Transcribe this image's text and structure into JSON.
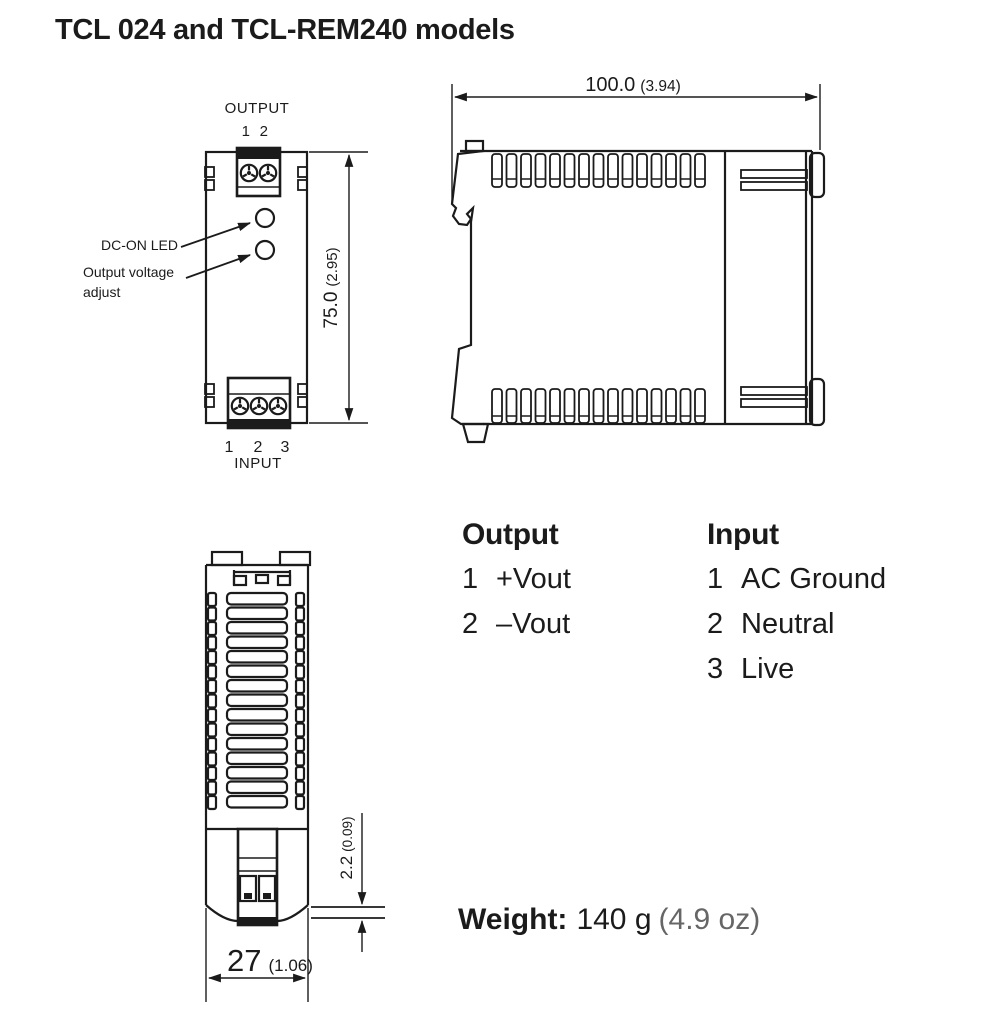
{
  "title": "TCL 024 and TCL-REM240 models",
  "front_view": {
    "output_label": "OUTPUT",
    "output_pin_1": "1",
    "output_pin_2": "2",
    "dc_on_led_label": "DC-ON LED",
    "adjust_label_line1": "Output voltage",
    "adjust_label_line2": "adjust",
    "height_mm": "75.0",
    "height_in": "(2.95)",
    "input_pin_1": "1",
    "input_pin_2": "2",
    "input_pin_3": "3",
    "input_label": "INPUT"
  },
  "side_view": {
    "width_mm": "100.0",
    "width_in": "(3.94)"
  },
  "top_view": {
    "depth_mm": "27",
    "depth_in": "(1.06)",
    "protrusion_mm": "2.2",
    "protrusion_in": "(0.09)"
  },
  "legend": {
    "output_heading": "Output",
    "output_items": [
      {
        "num": "1",
        "label": "+Vout"
      },
      {
        "num": "2",
        "label": "–Vout"
      }
    ],
    "input_heading": "Input",
    "input_items": [
      {
        "num": "1",
        "label": "AC Ground"
      },
      {
        "num": "2",
        "label": "Neutral"
      },
      {
        "num": "3",
        "label": "Live"
      }
    ]
  },
  "weight": {
    "label": "Weight:",
    "grams": "140 g",
    "ounces": "(4.9 oz)"
  },
  "colors": {
    "line": "#1b1b1b",
    "muted": "#666666"
  }
}
